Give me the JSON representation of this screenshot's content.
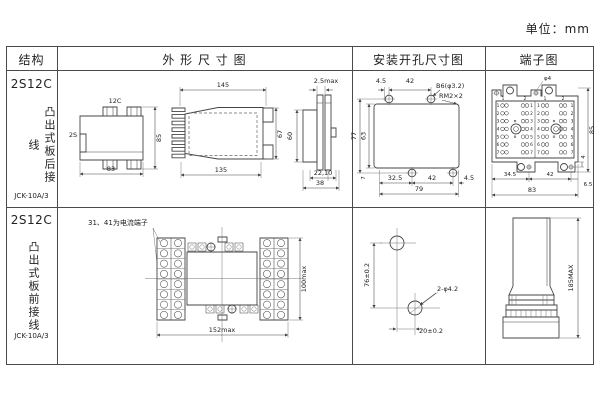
{
  "unit_label": "单位：mm",
  "headers": {
    "structure": "结构",
    "outline": "外 形 尺 寸 图",
    "mounting": "安装开孔尺寸图",
    "terminal": "端子图"
  },
  "row1": {
    "model": "2S12C",
    "mount_type": "凸出式板后接线",
    "code": "JCK-10A/3",
    "outline": {
      "front_top": "12C",
      "front_left": "2S",
      "front_width": "83",
      "front_height": "85",
      "side_top": "145",
      "side_bottom": "135",
      "side_height": "67",
      "rear_top": "2.5max",
      "rear_height": "60",
      "rear_b1": "22,10",
      "rear_b2": "38"
    },
    "mounting": {
      "top1": "4.5",
      "top2": "42",
      "hole_label": "B6(φ3.2)",
      "corner_label": "RM2×2",
      "left_outer": "77",
      "left_inner": "63",
      "bottom_small": "7",
      "b1": "32.5",
      "b2": "42",
      "b3": "4.5",
      "total": "79"
    },
    "terminal": {
      "hole_label": "φ4",
      "height": "85",
      "ear": "4",
      "b1": "34.5",
      "b2": "42",
      "b3": "6.5",
      "total": "83",
      "cols": [
        "1",
        "2",
        "1",
        "2"
      ],
      "rows": [
        "1",
        "2",
        "3",
        "4",
        "5",
        "6",
        "7"
      ]
    }
  },
  "row2": {
    "model": "2S12C",
    "mount_type": "凸出式板前接线",
    "code": "JCK-10A/3",
    "drawing": {
      "note": "31、41为电流端子",
      "height": "100max",
      "width": "152max"
    },
    "mounting": {
      "v": "76±0.2",
      "hole_label": "2-φ4.2",
      "h": "20±0.2"
    },
    "terminal": {
      "height": "185MAX"
    }
  }
}
